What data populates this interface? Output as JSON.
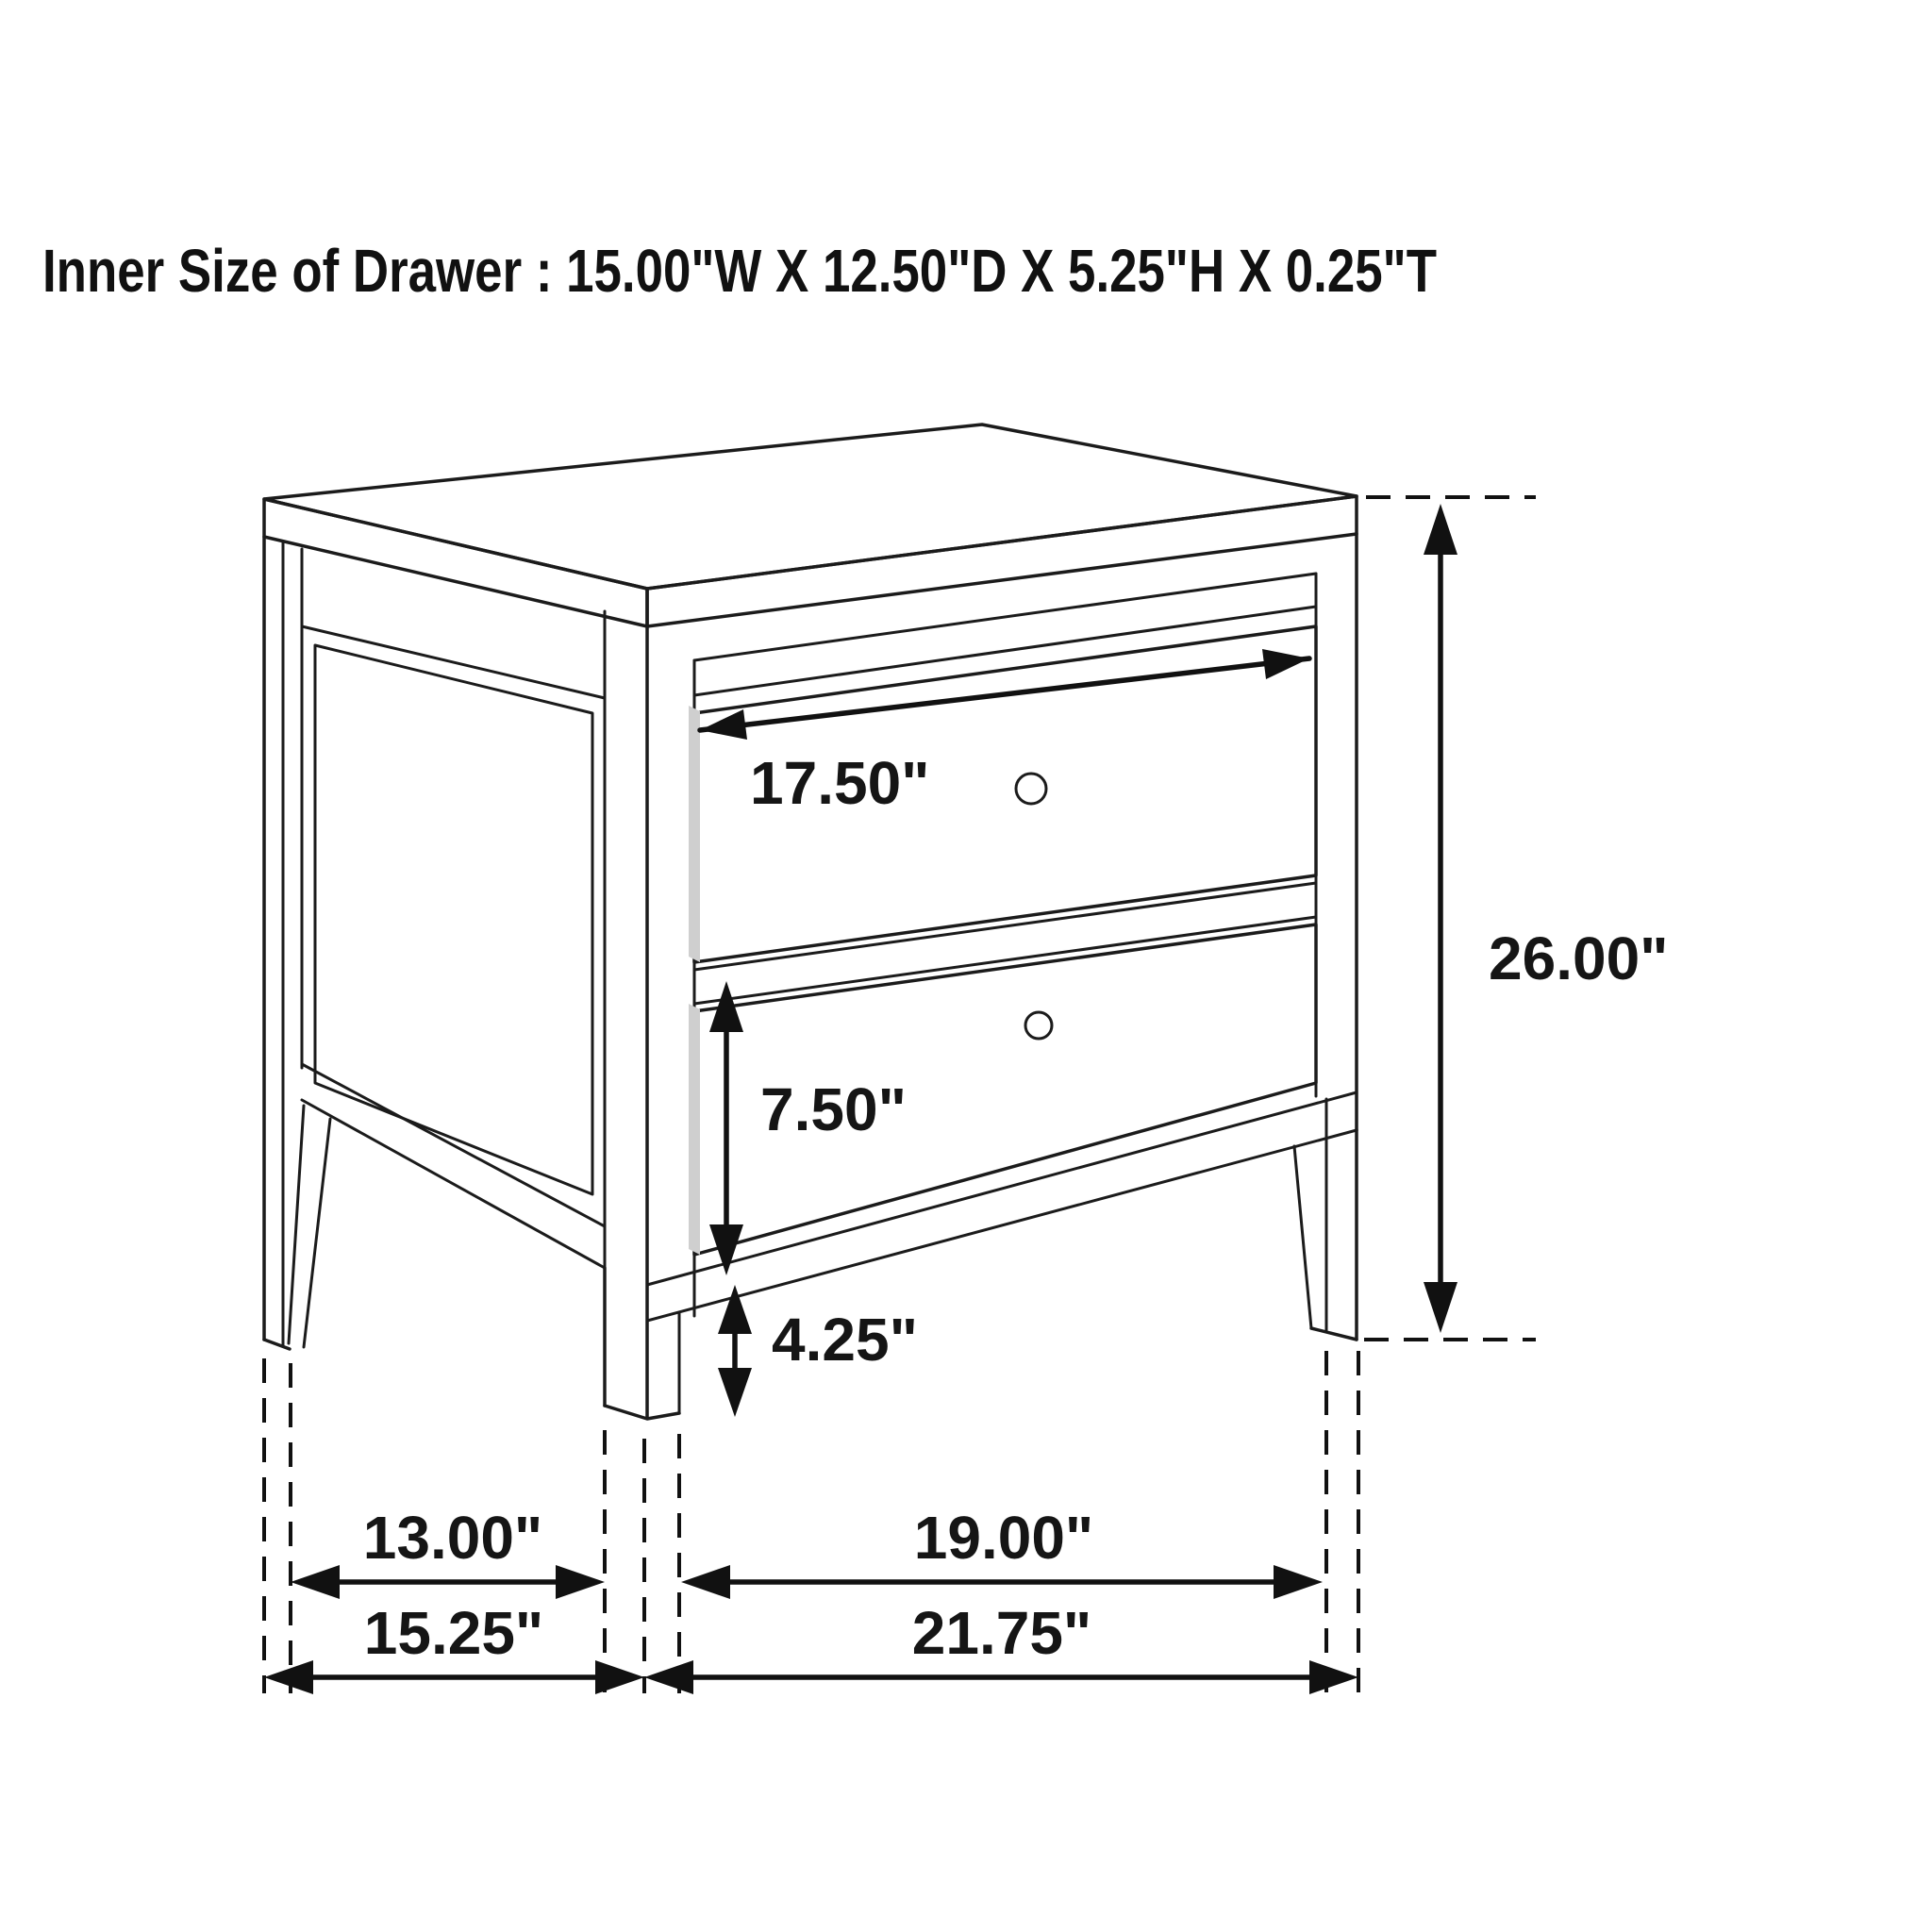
{
  "title": "Inner Size of Drawer : 15.00\"W X 12.50\"D X 5.25\"H X 0.25\"T",
  "product": "two-drawer nightstand dimension diagram",
  "colors": {
    "line": "#1b1b1b",
    "background": "#ffffff",
    "shade": "#cfcfcf"
  },
  "dims": {
    "drawer_face_width": "17.50\"",
    "overall_height": "26.00\"",
    "lower_drawer_height": "7.50\"",
    "floor_clearance": "4.25\"",
    "inner_depth": "13.00\"",
    "inner_width": "19.00\"",
    "overall_depth": "15.25\"",
    "overall_width": "21.75\""
  }
}
